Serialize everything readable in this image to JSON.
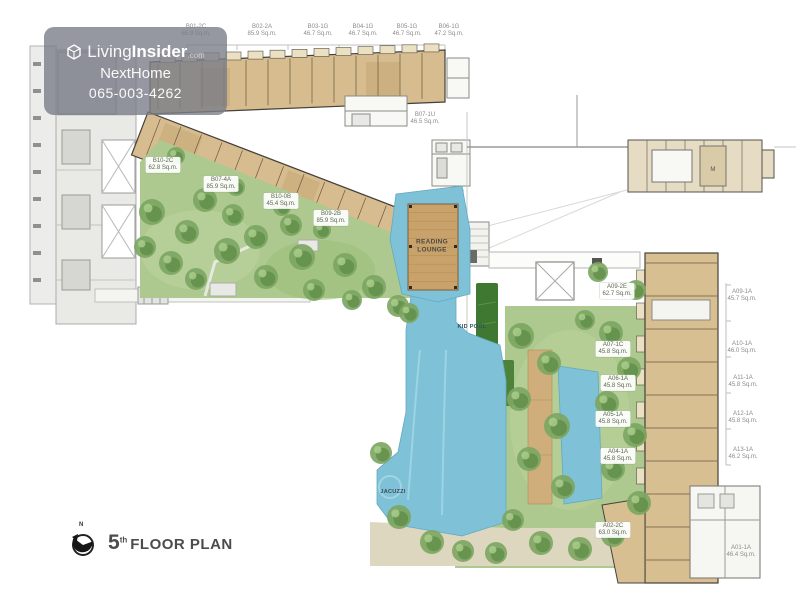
{
  "watermark": {
    "brand_prefix": "Living",
    "brand_suffix": "Insider",
    "brand_tld": ".com",
    "subtitle": "NextHome",
    "phone": "065-003-4262"
  },
  "plan_title": {
    "compass_n": "N",
    "floor_number": "5",
    "floor_ordinal": "th",
    "label": "FLOOR PLAN"
  },
  "amenities": {
    "reading_lounge_line1": "READING",
    "reading_lounge_line2": "LOUNGE",
    "kid_pool": "KID POOL",
    "jacuzzi": "JACUZZI",
    "mech_room": "M"
  },
  "units": {
    "top_row": [
      {
        "code": "B01-2C",
        "area": "65.9 Sq.m."
      },
      {
        "code": "B02-2A",
        "area": "85.9 Sq.m."
      },
      {
        "code": "B03-1G",
        "area": "46.7 Sq.m."
      },
      {
        "code": "B04-1G",
        "area": "46.7 Sq.m."
      },
      {
        "code": "B05-1G",
        "area": "46.7 Sq.m."
      },
      {
        "code": "B06-1G",
        "area": "47.2 Sq.m."
      }
    ],
    "b_wing": [
      {
        "code": "B07-1U",
        "area": "46.5 Sq.m."
      },
      {
        "code": "B10-2C",
        "area": "62.8 Sq.m."
      },
      {
        "code": "B07-4A",
        "area": "85.9 Sq.m."
      },
      {
        "code": "B10-0B",
        "area": "45.4 Sq.m."
      },
      {
        "code": "B09-2B",
        "area": "85.9 Sq.m."
      }
    ],
    "a_wing_garden": [
      {
        "code": "A09-2E",
        "area": "62.7 Sq.m."
      },
      {
        "code": "A07-1C",
        "area": "45.8 Sq.m."
      },
      {
        "code": "A06-1A",
        "area": "45.8 Sq.m."
      },
      {
        "code": "A05-1A",
        "area": "45.8 Sq.m."
      },
      {
        "code": "A04-1A",
        "area": "45.8 Sq.m."
      },
      {
        "code": "A02-2C",
        "area": "63.0 Sq.m."
      }
    ],
    "a_wing_right": [
      {
        "code": "A09-1A",
        "area": "45.7 Sq.m."
      },
      {
        "code": "A10-1A",
        "area": "46.0 Sq.m."
      },
      {
        "code": "A11-1A",
        "area": "45.8 Sq.m."
      },
      {
        "code": "A12-1A",
        "area": "45.8 Sq.m."
      },
      {
        "code": "A13-1A",
        "area": "46.2 Sq.m."
      },
      {
        "code": "A01-1A",
        "area": "46.4 Sq.m."
      }
    ]
  },
  "colors": {
    "unit_fill": "#d6bc8e",
    "pool": "#7fc1d6",
    "garden": "#adc98f",
    "tree": "#5d8c46",
    "hedge": "#3f7831",
    "deck": "#c8a26a",
    "watermark_bg": "#7a7d8a"
  }
}
